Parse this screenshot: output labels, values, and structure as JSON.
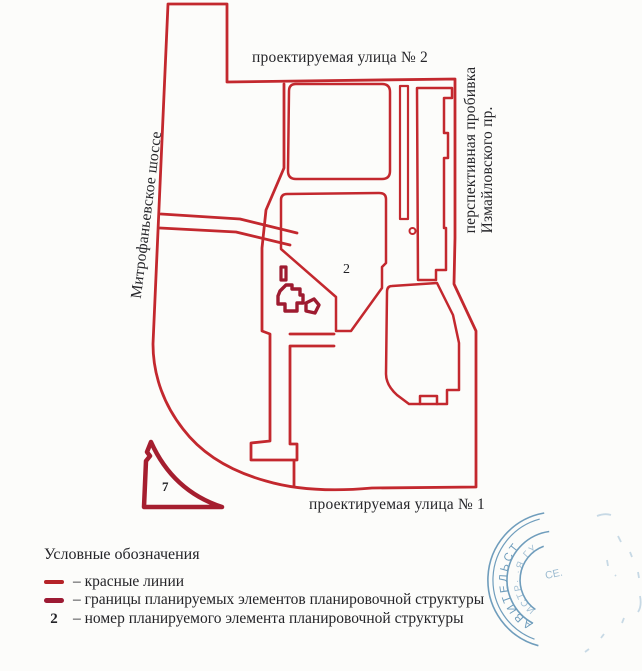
{
  "map": {
    "street_label_top": "проектируемая улица № 2",
    "street_label_bottom": "проектируемая улица № 1",
    "road_label_left": "Митрофаньевское шоссе",
    "road_label_right_line1": "перспективная пробивка",
    "road_label_right_line2": "Измайловского пр.",
    "element_number_center": "2",
    "element_number_triangle": "7"
  },
  "legend": {
    "title": "Условные обозначения",
    "items": [
      {
        "symbol": "red-line-swatch",
        "label": "– красные линии"
      },
      {
        "symbol": "dark-red-line-swatch",
        "label": "– границы планируемых элементов планировочной структуры"
      },
      {
        "symbol": "2",
        "label": "– номер планируемого элемента планировочной структуры"
      }
    ]
  },
  "stamp": {
    "arc_text": "АВИТЕЛЬСТ",
    "inner_arc_text": "ИСТР·  ·Я ГУ",
    "center_text": "СЕ."
  },
  "colors": {
    "red_line": "#c3282e",
    "dark_red": "#9e1b30",
    "stamp_blue": "#4d86ad",
    "text": "#26262a",
    "paper": "#fcfcfa"
  }
}
